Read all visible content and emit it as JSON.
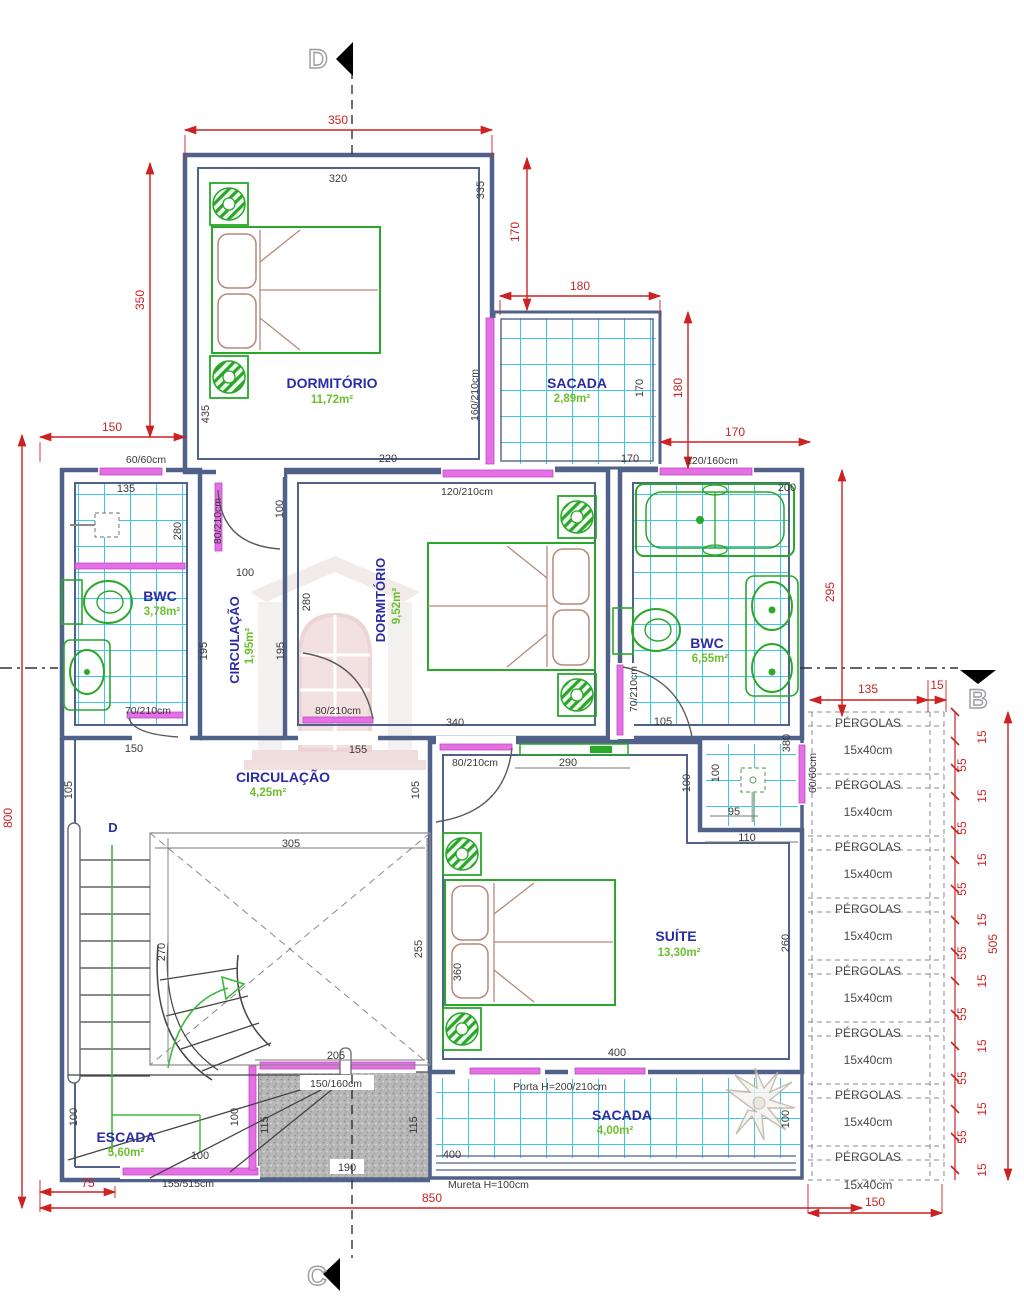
{
  "title": "Planta – Pavimento Superior",
  "markers": {
    "top": "D",
    "bottom": "C",
    "side": "B"
  },
  "rooms": {
    "dorm1": {
      "name": "DORMITÓRIO",
      "area": "11,72m²"
    },
    "sacada1": {
      "name": "SACADA",
      "area": "2,89m²"
    },
    "bwc1": {
      "name": "BWC",
      "area": "3,78m²"
    },
    "circ1": {
      "name": "CIRCULAÇÃO",
      "area": "1,95m²"
    },
    "dorm2": {
      "name": "DORMITÓRIO",
      "area": "9,52m²"
    },
    "bwc2": {
      "name": "BWC",
      "area": "6,55m²"
    },
    "circ2": {
      "name": "CIRCULAÇÃO",
      "area": "4,25m²"
    },
    "suite": {
      "name": "SUÍTE",
      "area": "13,30m²"
    },
    "escada": {
      "name": "ESCADA",
      "area": "5,60m²"
    },
    "sacada2": {
      "name": "SACADA",
      "area": "4,00m²"
    }
  },
  "stairs": {
    "ref": "D"
  },
  "openings": {
    "w60a": "60/60cm",
    "w60b": "60/60cm",
    "d80a": "80/210cm",
    "d80b": "80/210cm",
    "d80c": "80/210cm",
    "d70a": "70/210cm",
    "d70b": "70/210cm",
    "w120a": "120/210cm",
    "w120b": "120/160cm",
    "w160": "160/210cm",
    "w150": "150/160cm",
    "w155": "155/515cm",
    "porta": "Porta H=200/210cm",
    "mureta": "Mureta H=100cm"
  },
  "dims_red": {
    "t350": "350",
    "l350": "350",
    "l150": "150",
    "r170": "170",
    "s180h": "180",
    "s180v": "180",
    "r170h": "170",
    "b295": "295",
    "p135": "135",
    "p15": "15",
    "p505": "505",
    "l800": "800",
    "b850": "850",
    "p150": "150",
    "e75": "75"
  },
  "dims": {
    "d320": "320",
    "d335": "335",
    "d435": "435",
    "s170a": "170",
    "s170b": "170",
    "d135": "135",
    "d280a": "280",
    "d100a": "100",
    "d100b": "100",
    "d195a": "195",
    "d195b": "195",
    "d150a": "150",
    "d220": "220",
    "d280b": "280",
    "d340": "340",
    "d200": "200",
    "d155": "155",
    "d290": "290",
    "d105a": "105",
    "d105b": "105",
    "d105c": "105",
    "d100c": "100",
    "d100d": "100",
    "d380": "380",
    "d95": "95",
    "d110": "110",
    "d360": "360",
    "d260": "260",
    "d400a": "400",
    "d400b": "400",
    "d100e": "100",
    "d305": "305",
    "d270": "270",
    "d255": "255",
    "d205": "205",
    "d115a": "115",
    "d115b": "115",
    "d190": "190",
    "d100f": "100",
    "d100g": "100",
    "d100h": "100"
  },
  "chain": {
    "ticks": [
      "15",
      "55",
      "15",
      "55",
      "15",
      "55",
      "15",
      "55",
      "15",
      "55",
      "15",
      "55",
      "15",
      "55",
      "15"
    ]
  },
  "pergolas": {
    "rows": [
      {
        "label": "PÉRGOLAS",
        "size": "15x40cm"
      },
      {
        "label": "PÉRGOLAS",
        "size": "15x40cm"
      },
      {
        "label": "PÉRGOLAS",
        "size": "15x40cm"
      },
      {
        "label": "PÉRGOLAS",
        "size": "15x40cm"
      },
      {
        "label": "PÉRGOLAS",
        "size": "15x40cm"
      },
      {
        "label": "PÉRGOLAS",
        "size": "15x40cm"
      },
      {
        "label": "PÉRGOLAS",
        "size": "15x40cm"
      },
      {
        "label": "PÉRGOLAS",
        "size": "15x40cm"
      }
    ]
  }
}
